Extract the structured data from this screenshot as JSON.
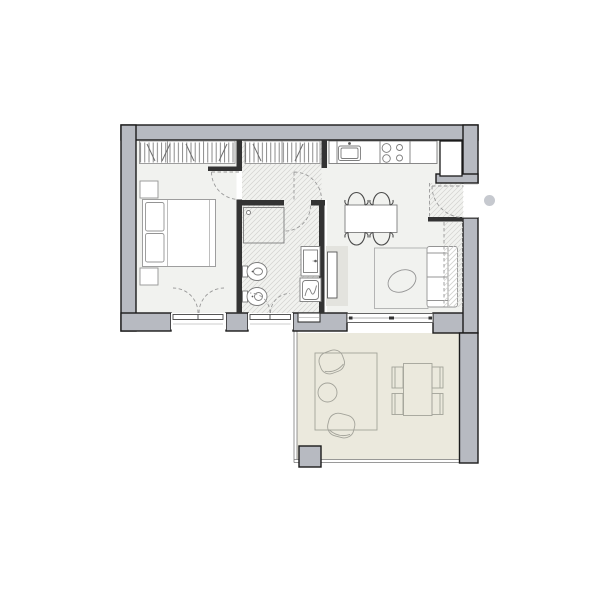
{
  "title": "two-room-apartment-floor-plan",
  "colors": {
    "paper": "#ffffff",
    "wall": "#b7bac1",
    "wall_outline": "#1b1b1b",
    "interior_wall": "#333333",
    "floor": "#f1f2ef",
    "hatch_line": "#d2d2cf",
    "hanger_stroke": "#6e6e6e",
    "terrace_floor": "#ebe9dd",
    "furniture_stroke": "#949494",
    "fixture_stroke": "#7d7d7d",
    "chair_stroke": "#4a4a4a",
    "outdoor_stroke": "#a3a39a",
    "rug_stroke": "#a5a5a5",
    "railing_stroke": "#7a7a7a",
    "dashed_stroke": "#9a9a9a",
    "frame_stroke": "#444444",
    "sill_stroke": "#bbbbbb",
    "tv_unit": "#e3e3de",
    "dot": "#c6c9cf",
    "white": "#ffffff",
    "appliance_dot": "#555555"
  },
  "inventory": {
    "rooms": [
      "bedroom",
      "corridor",
      "bathroom",
      "kitchen-living-room",
      "entry",
      "terrace"
    ],
    "symbols": [
      "double-bed",
      "nightstand",
      "wardrobe-hanging-rail",
      "shower",
      "bidet",
      "toilet",
      "washbasin-vanity",
      "washing-machine",
      "kitchen-counter",
      "sink",
      "cooktop",
      "refrigerator-column",
      "dining-table",
      "dining-chair",
      "tv-unit",
      "rug",
      "pouf",
      "sofa",
      "sliding-glass-door",
      "french-window",
      "door-swing",
      "terrace-railing",
      "outdoor-lounge-chair",
      "outdoor-side-table",
      "outdoor-dining-set",
      "column"
    ]
  }
}
